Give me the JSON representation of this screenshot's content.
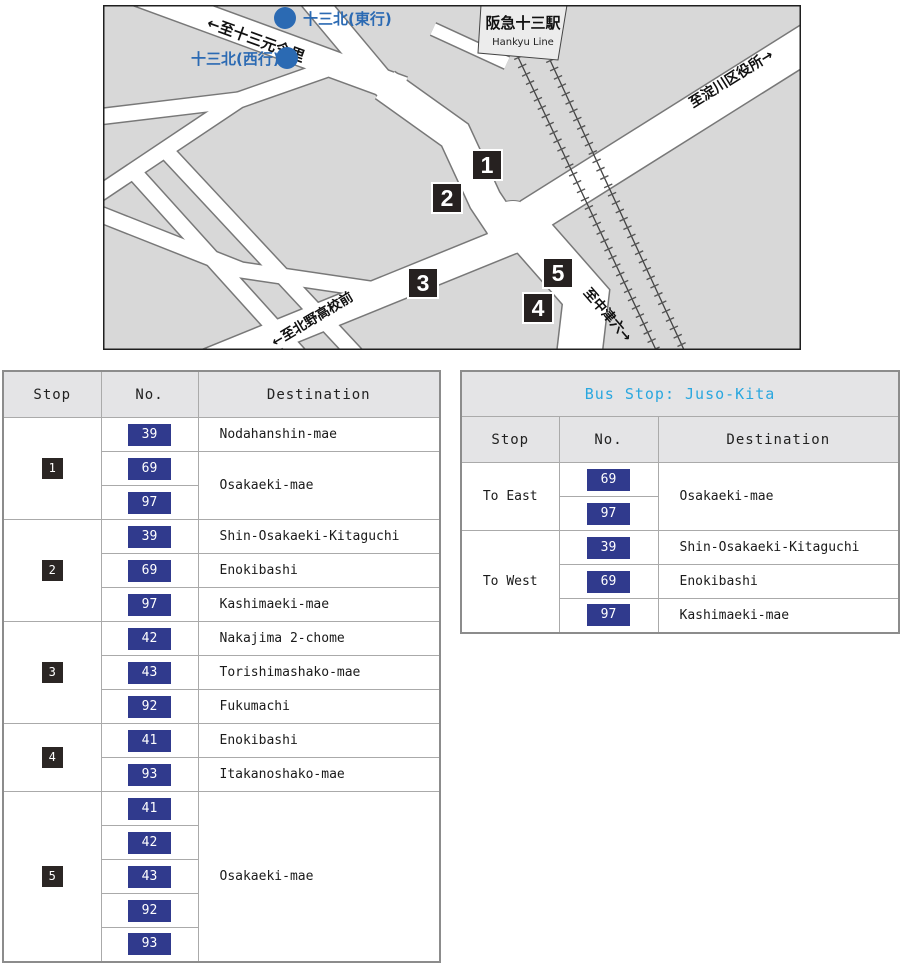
{
  "map": {
    "station_name": "阪急十三駅",
    "station_line": "Hankyu Line",
    "stop_east": "十三北(東行)",
    "stop_west": "十三北(西行)",
    "roads": {
      "imazato": "←至十三元今里",
      "yodogawa": "至淀川区役所→",
      "kitano": "←至北野高校前",
      "nakatsu": "至中津六→"
    },
    "markers": [
      "1",
      "2",
      "3",
      "4",
      "5"
    ]
  },
  "left": {
    "headers": {
      "stop": "Stop",
      "no": "No.",
      "dest": "Destination"
    },
    "groups": [
      {
        "stop": "1",
        "rows": [
          {
            "no": "39",
            "dest": "Nodahanshin-mae"
          },
          {
            "no": "69",
            "dest": "Osakaeki-mae"
          },
          {
            "no": "97"
          }
        ]
      },
      {
        "stop": "2",
        "rows": [
          {
            "no": "39",
            "dest": "Shin-Osakaeki-Kitaguchi"
          },
          {
            "no": "69",
            "dest": "Enokibashi"
          },
          {
            "no": "97",
            "dest": "Kashimaeki-mae"
          }
        ]
      },
      {
        "stop": "3",
        "rows": [
          {
            "no": "42",
            "dest": "Nakajima 2-chome"
          },
          {
            "no": "43",
            "dest": "Torishimashako-mae"
          },
          {
            "no": "92",
            "dest": "Fukumachi"
          }
        ]
      },
      {
        "stop": "4",
        "rows": [
          {
            "no": "41",
            "dest": "Enokibashi"
          },
          {
            "no": "93",
            "dest": "Itakanoshako-mae"
          }
        ]
      },
      {
        "stop": "5",
        "rows": [
          {
            "no": "41",
            "dest": "Osakaeki-mae"
          },
          {
            "no": "42"
          },
          {
            "no": "43"
          },
          {
            "no": "92"
          },
          {
            "no": "93"
          }
        ]
      }
    ]
  },
  "right": {
    "title": "Bus Stop: Juso-Kita",
    "headers": {
      "stop": "Stop",
      "no": "No.",
      "dest": "Destination"
    },
    "groups": [
      {
        "stop": "To East",
        "rows": [
          {
            "no": "69",
            "dest": "Osakaeki-mae"
          },
          {
            "no": "97"
          }
        ]
      },
      {
        "stop": "To West",
        "rows": [
          {
            "no": "39",
            "dest": "Shin-Osakaeki-Kitaguchi"
          },
          {
            "no": "69",
            "dest": "Enokibashi"
          },
          {
            "no": "97",
            "dest": "Kashimaeki-mae"
          }
        ]
      }
    ]
  },
  "colors": {
    "route_badge": "#303a8d",
    "marker": "#262120",
    "bus_point_blue": "#2b6ab3",
    "title_cyan": "#2aa7df",
    "block_gray": "#d8d8d8",
    "header_gray": "#e4e4e6"
  }
}
